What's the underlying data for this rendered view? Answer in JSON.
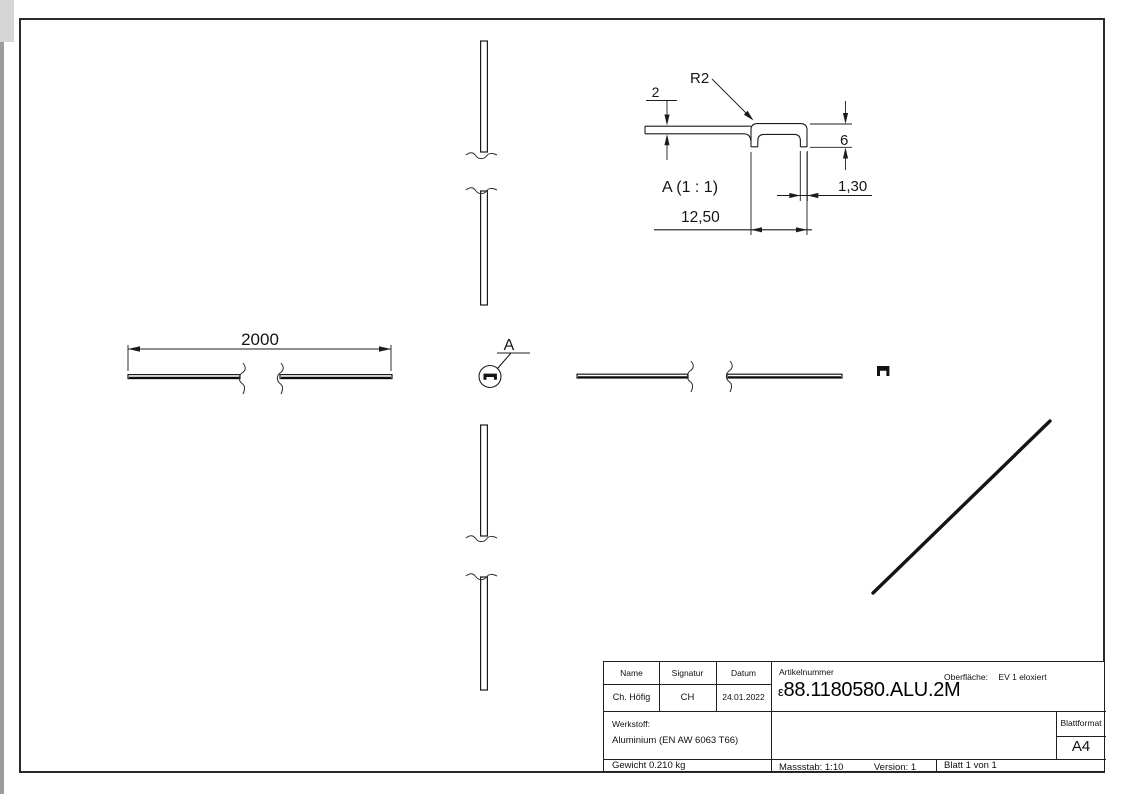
{
  "colors": {
    "line": "#1c1c1c",
    "paper": "#ffffff"
  },
  "views": {
    "front_left": {
      "length_dim": "2000"
    },
    "detail_callout": {
      "label": "A"
    },
    "detail": {
      "title": "A (1 : 1)",
      "radius": "R2",
      "sheet_thickness": "2",
      "leg_depth": "6",
      "wall_thickness": "1,30",
      "channel_width": "12,50"
    }
  },
  "title_block": {
    "name_label": "Name",
    "signatur_label": "Signatur",
    "datum_label": "Datum",
    "name_value": "Ch. Höfig",
    "signatur_value": "CH",
    "datum_value": "24.01.2022",
    "artikelnummer_label": "Artikelnummer",
    "artikelnummer_prefix": "ε",
    "artikelnummer_value": "88.1180580.ALU.2M",
    "oberflaeche_label": "Oberfläche:",
    "oberflaeche_value": "EV 1 eloxiert",
    "werkstoff_label": "Werkstoff:",
    "werkstoff_value": "Aluminium (EN AW 6063 T66)",
    "gewicht_value": "Gewicht 0.210 kg",
    "massstab_value": "Massstab: 1:10",
    "version_value": "Version: 1",
    "blatt_value": "Blatt 1 von 1",
    "blattformat_label": "Blattformat",
    "blattformat_value": "A4"
  }
}
